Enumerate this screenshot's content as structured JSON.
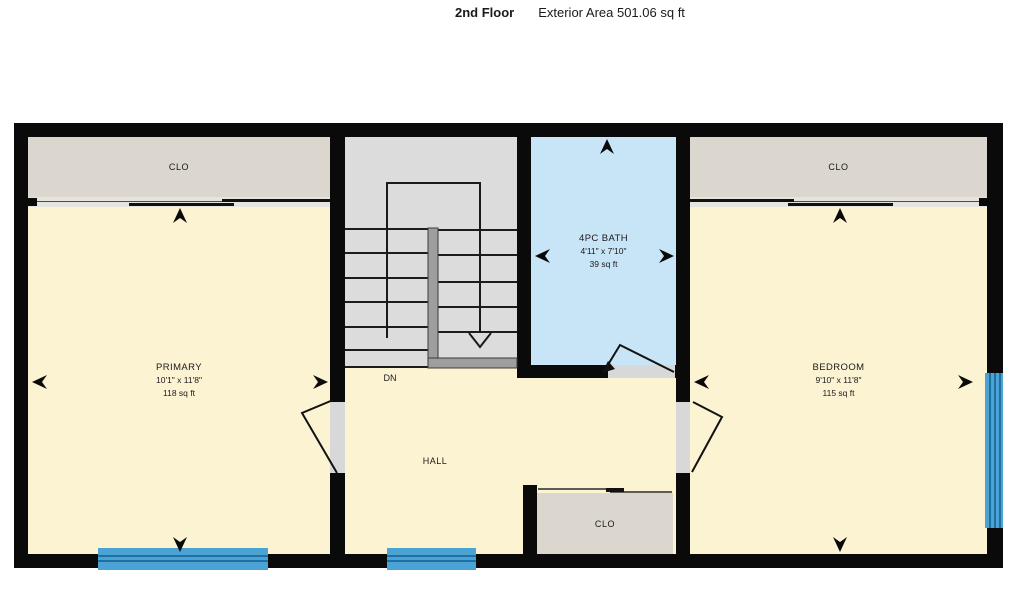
{
  "title": {
    "floor_label": "2nd Floor",
    "area_label": "Exterior Area 501.06 sq ft"
  },
  "rooms": {
    "primary": {
      "name": "PRIMARY",
      "dimensions": "10'1\" x 11'8\"",
      "area": "118 sq ft"
    },
    "bath": {
      "name": "4PC BATH",
      "dimensions": "4'11\" x 7'10\"",
      "area": "39 sq ft"
    },
    "bedroom": {
      "name": "BEDROOM",
      "dimensions": "9'10\" x 11'8\"",
      "area": "115 sq ft"
    },
    "hall": {
      "name": "HALL"
    },
    "closet_left": {
      "name": "CLO"
    },
    "closet_right": {
      "name": "CLO"
    },
    "closet_hall": {
      "name": "CLO"
    },
    "stairs": {
      "direction_label": "DN"
    }
  },
  "colors": {
    "wall": "#0a0a0a",
    "room_fill": "#fcf3d3",
    "closet_fill": "#dbd6ce",
    "stairs_fill": "#dcdcdc",
    "stairs_rail": "#9e9e9e",
    "bath_fill": "#c8e4f7",
    "window_blue": "#4aa3d4",
    "window_line": "#1f6fa0",
    "door_gap": "#d8d8d8"
  }
}
